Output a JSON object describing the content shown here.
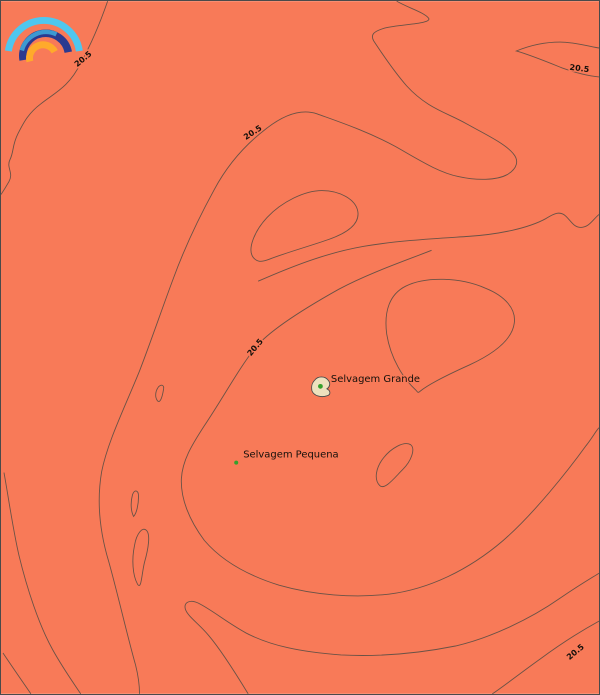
{
  "map": {
    "title": "Sea surface temperature contour map - Selvagens Islands",
    "contour_labels": [
      {
        "text": "20.5",
        "x": 84,
        "y": 60,
        "rotation": -40
      },
      {
        "text": "20.5",
        "x": 580,
        "y": 70,
        "rotation": 7
      },
      {
        "text": "20.5",
        "x": 254,
        "y": 134,
        "rotation": -33
      },
      {
        "text": "20.5",
        "x": 257,
        "y": 349,
        "rotation": -50
      },
      {
        "text": "20.5",
        "x": 578,
        "y": 655,
        "rotation": -40
      }
    ],
    "region_labels": [
      {
        "text": "Selvagem Grande",
        "x": 331,
        "y": 382
      },
      {
        "text": "Selvagem Pequena",
        "x": 243,
        "y": 458
      }
    ],
    "markers": [
      {
        "name": "selvagem-grande-dot",
        "x": 320.5,
        "y": 386.5,
        "r": 2.4
      },
      {
        "name": "selvagem-pequena-dot",
        "x": 236,
        "y": 463,
        "r": 2
      }
    ]
  },
  "colors": {
    "sea": "#F87A58",
    "contour": "#6A5246",
    "label": "#16100B",
    "island_fill": "#EDE1BE",
    "island_stroke": "#4b4b4b",
    "marker_green": "#35A02C",
    "border": "#4a4a4a"
  },
  "logo": {
    "name": "rainbow-logo",
    "arc_colors": {
      "outer_cyan": "#4FC7EF",
      "middle_navy": "#2B3A90",
      "highlight_blue": "#3D9AD1",
      "inner_amber": "#FFAA2B"
    }
  }
}
